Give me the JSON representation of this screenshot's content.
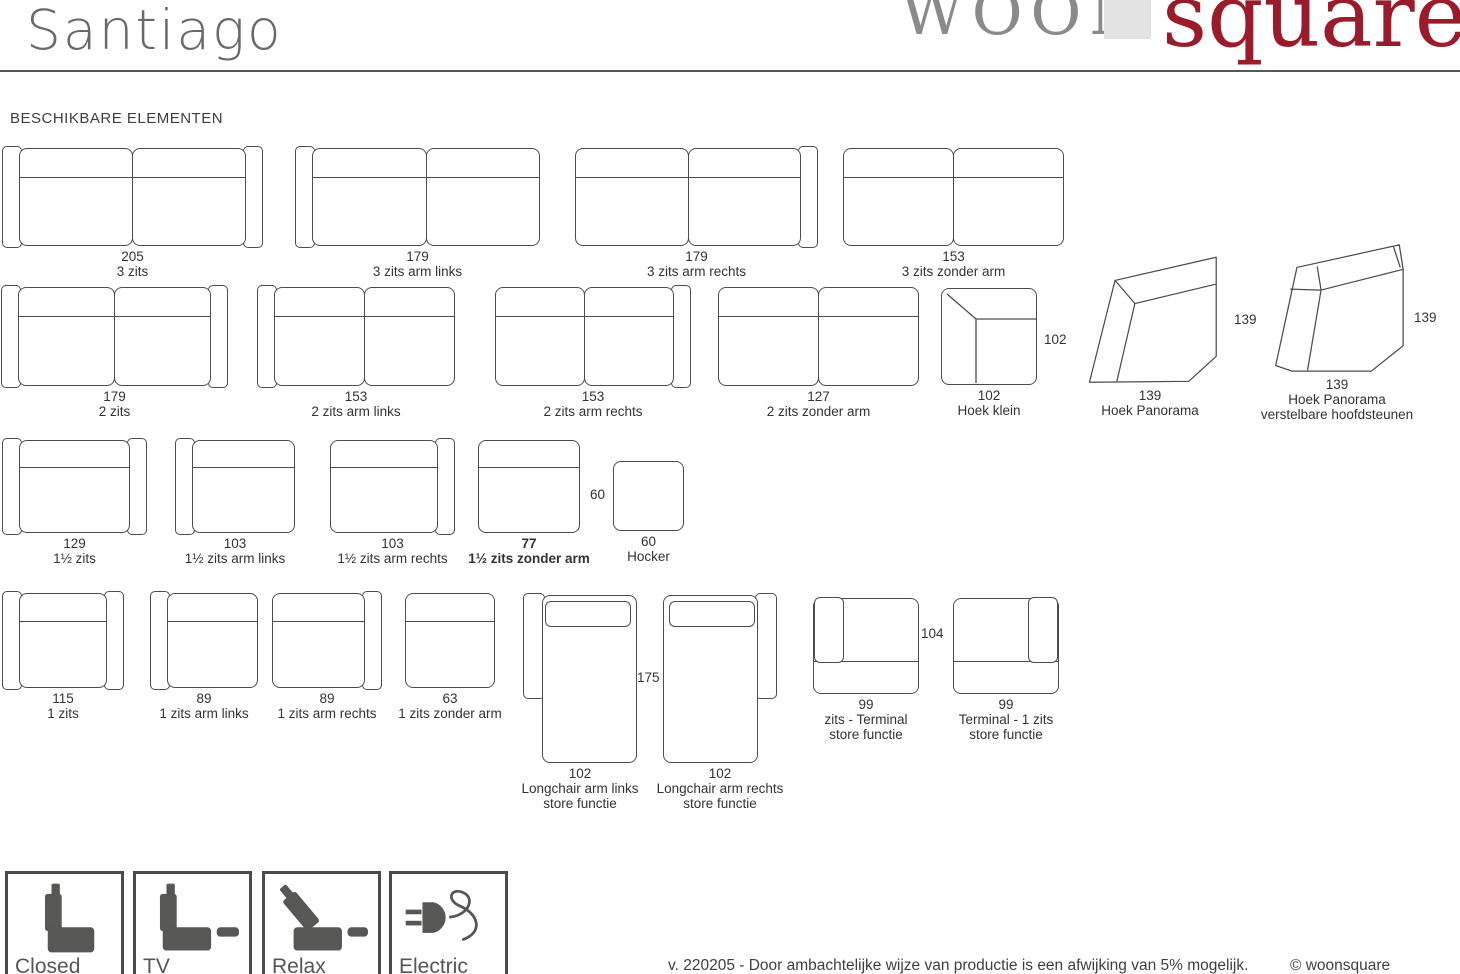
{
  "page": {
    "title": "Santiago",
    "section_heading": "BESCHIKBARE ELEMENTEN",
    "footer_note": "v. 220205 - Door ambachtelijke wijze van productie is een afwijking van 5% mogelijk.",
    "footer_copyright": "© woonsquare"
  },
  "logo": {
    "part1": "WOON",
    "part2": "square",
    "part1_color": "#8a8a8a",
    "part2_color": "#9b1b2b",
    "square_color": "#e4e3e3"
  },
  "colors": {
    "line": "#4c4c4c",
    "text": "#333333",
    "icon": "#575756",
    "title": "#696969"
  },
  "modules": [
    {
      "name": "3-zits",
      "type": "sofa",
      "arms": "both",
      "seats": 2,
      "x": 2,
      "y": 148,
      "w": 261,
      "h": 98,
      "label": [
        "205",
        "3 zits"
      ]
    },
    {
      "name": "3-zits-arm-links",
      "type": "sofa",
      "arms": "left",
      "seats": 2,
      "x": 295,
      "y": 148,
      "w": 245,
      "h": 98,
      "label": [
        "179",
        "3 zits arm links"
      ]
    },
    {
      "name": "3-zits-arm-rechts",
      "type": "sofa",
      "arms": "right",
      "seats": 2,
      "x": 575,
      "y": 148,
      "w": 243,
      "h": 98,
      "label": [
        "179",
        "3 zits arm rechts"
      ]
    },
    {
      "name": "3-zits-zonder-arm",
      "type": "sofa",
      "arms": "none",
      "seats": 2,
      "x": 843,
      "y": 148,
      "w": 221,
      "h": 98,
      "label": [
        "153",
        "3 zits zonder arm"
      ]
    },
    {
      "name": "2-zits",
      "type": "sofa",
      "arms": "both",
      "seats": 2,
      "x": 1,
      "y": 287,
      "w": 227,
      "h": 99,
      "label": [
        "179",
        "2 zits"
      ]
    },
    {
      "name": "2-zits-arm-links",
      "type": "sofa",
      "arms": "left",
      "seats": 2,
      "x": 257,
      "y": 287,
      "w": 198,
      "h": 99,
      "label": [
        "153",
        "2 zits arm links"
      ]
    },
    {
      "name": "2-zits-arm-rechts",
      "type": "sofa",
      "arms": "right",
      "seats": 2,
      "x": 495,
      "y": 287,
      "w": 196,
      "h": 99,
      "label": [
        "153",
        "2 zits arm rechts"
      ]
    },
    {
      "name": "2-zits-zonder-arm",
      "type": "sofa",
      "arms": "none",
      "seats": 2,
      "x": 718,
      "y": 287,
      "w": 201,
      "h": 99,
      "label": [
        "127",
        "2 zits zonder arm"
      ]
    },
    {
      "name": "hoek-klein",
      "type": "corner-small",
      "x": 941,
      "y": 288,
      "w": 96,
      "h": 97,
      "label": [
        "102",
        "Hoek klein"
      ],
      "side_label": {
        "text": "102",
        "x": 1044,
        "y": 332
      }
    },
    {
      "name": "hoek-panorama",
      "type": "panorama",
      "x": 1080,
      "y": 248,
      "w": 140,
      "h": 137,
      "label": [
        "139",
        "Hoek Panorama"
      ],
      "side_label": {
        "text": "139",
        "x": 1234,
        "y": 312
      }
    },
    {
      "name": "hoek-panorama-verstelbare-hoofdsteunen",
      "type": "panorama-headrest",
      "x": 1267,
      "y": 242,
      "w": 140,
      "h": 132,
      "label": [
        "139",
        "Hoek Panorama",
        "verstelbare hoofdsteunen"
      ],
      "side_label": {
        "text": "139",
        "x": 1414,
        "y": 310
      }
    },
    {
      "name": "anderhalf-zits",
      "type": "sofa",
      "arms": "both",
      "seats": 1,
      "x": 2,
      "y": 440,
      "w": 145,
      "h": 93,
      "label": [
        "129",
        "1½ zits"
      ]
    },
    {
      "name": "anderhalf-zits-arm-links",
      "type": "sofa",
      "arms": "left",
      "seats": 1,
      "x": 175,
      "y": 440,
      "w": 120,
      "h": 93,
      "label": [
        "103",
        "1½ zits arm links"
      ]
    },
    {
      "name": "anderhalf-zits-arm-rechts",
      "type": "sofa",
      "arms": "right",
      "seats": 1,
      "x": 330,
      "y": 440,
      "w": 125,
      "h": 93,
      "label": [
        "103",
        "1½ zits arm rechts"
      ]
    },
    {
      "name": "anderhalf-zits-zonder-arm",
      "type": "sofa",
      "arms": "none",
      "seats": 1,
      "x": 478,
      "y": 440,
      "w": 102,
      "h": 93,
      "bold": true,
      "label": [
        "77",
        "1½ zits zonder arm"
      ]
    },
    {
      "name": "hocker",
      "type": "hocker",
      "x": 613,
      "y": 461,
      "w": 71,
      "h": 70,
      "label": [
        "60",
        "Hocker"
      ],
      "side_label": {
        "text": "60",
        "x": 590,
        "y": 487
      }
    },
    {
      "name": "1-zits",
      "type": "sofa",
      "arms": "both",
      "seats": 1,
      "x": 2,
      "y": 593,
      "w": 122,
      "h": 95,
      "label": [
        "115",
        "1 zits"
      ]
    },
    {
      "name": "1-zits-arm-links",
      "type": "sofa",
      "arms": "left",
      "seats": 1,
      "x": 150,
      "y": 593,
      "w": 108,
      "h": 95,
      "label": [
        "89",
        "1 zits arm links"
      ]
    },
    {
      "name": "1-zits-arm-rechts",
      "type": "sofa",
      "arms": "right",
      "seats": 1,
      "x": 272,
      "y": 593,
      "w": 110,
      "h": 95,
      "label": [
        "89",
        "1 zits arm rechts"
      ]
    },
    {
      "name": "1-zits-zonder-arm",
      "type": "sofa",
      "arms": "none",
      "seats": 1,
      "x": 405,
      "y": 593,
      "w": 90,
      "h": 95,
      "label": [
        "63",
        "1 zits zonder arm"
      ]
    },
    {
      "name": "longchair-arm-links",
      "type": "longchair-left",
      "x": 523,
      "y": 595,
      "w": 114,
      "h": 168,
      "label": [
        "102",
        "Longchair arm links",
        "store functie"
      ],
      "side_label": {
        "text": "175",
        "x": 637,
        "y": 670
      }
    },
    {
      "name": "longchair-arm-rechts",
      "type": "longchair-right",
      "x": 663,
      "y": 595,
      "w": 114,
      "h": 168,
      "label": [
        "102",
        "Longchair arm rechts",
        "store functie"
      ]
    },
    {
      "name": "zits-terminal-store-functie",
      "type": "terminal-left",
      "x": 813,
      "y": 598,
      "w": 106,
      "h": 96,
      "label": [
        "99",
        "zits - Terminal",
        "store functie"
      ],
      "side_label": {
        "text": "104",
        "x": 921,
        "y": 626
      }
    },
    {
      "name": "terminal-1-zits-store-functie",
      "type": "terminal-right",
      "x": 953,
      "y": 598,
      "w": 106,
      "h": 96,
      "label": [
        "99",
        "Terminal - 1 zits",
        "store functie"
      ]
    }
  ],
  "features": [
    {
      "name": "closed",
      "label": "Closed",
      "icon": "seat-upright-icon",
      "x": 5
    },
    {
      "name": "tv",
      "label": "TV",
      "icon": "seat-tv-icon",
      "x": 133
    },
    {
      "name": "relax",
      "label": "Relax",
      "icon": "seat-relax-icon",
      "x": 262
    },
    {
      "name": "electric",
      "label": "Electric",
      "icon": "power-plug-icon",
      "x": 389
    }
  ]
}
